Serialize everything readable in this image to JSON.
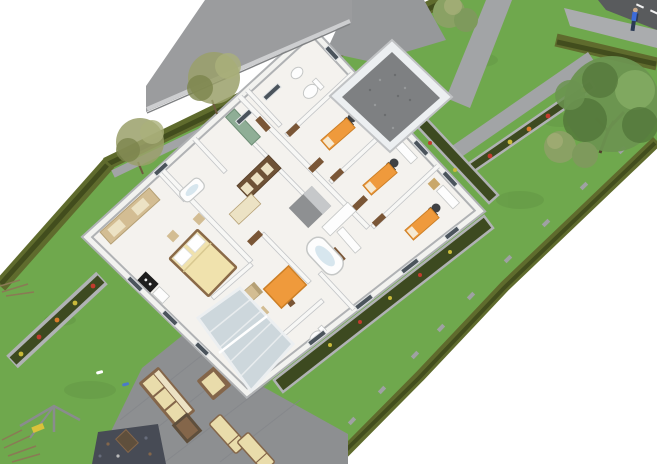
{
  "meta": {
    "description": "3D architectural visualization: bird's-eye cutaway view of a single-storey house floor plan on a long rotated garden plot",
    "render_style": "SketchUp-like model render, no visible text",
    "canvas": {
      "width": 657,
      "height": 464
    }
  },
  "palette": {
    "bg": "#ffffff",
    "lawn": "#6fa84d",
    "lawn_spot": "#619a42",
    "hedge": "#5f6b2d",
    "hedge_dark": "#424d1d",
    "bed_soil": "#3d4a20",
    "curb": "#b0b2b4",
    "path": "#a2a4a6",
    "driveway": "#96989a",
    "patio": "#8d8f91",
    "patio_line": "#84868a",
    "pebbles": "#474b55",
    "road": "#595b5d",
    "sidewalk": "#aaacae",
    "road_mark": "#f2f2f2",
    "roof": "#9b9c9e",
    "roof_fascia": "#cdced0",
    "gravel": "#7e8082",
    "gravel_dot_dark": "#6a6c6e",
    "gravel_dot_light": "#97999b",
    "floor": "#f4f2ee",
    "wall_white": "#f2f2ef",
    "wall_edge": "#b0b2b4",
    "wall_inner": "#f7f7f5",
    "wall_inner_edge": "#c3c5c7",
    "door_wood": "#7a5636",
    "window_dark": "#4b545c",
    "window_frame": "#dfe2e4",
    "glass_green": "#8fae96",
    "glass_green_edge": "#6e8e76",
    "conservatory_glass": "#cdd7dc",
    "conservatory_frame": "#eceff1",
    "cream": "#e9dcab",
    "cream_light": "#ece2c4",
    "tan": "#d3bd93",
    "tan_dark": "#b5a075",
    "wood_brown": "#84664a",
    "wood_dark": "#5f4f3c",
    "bed_spread": "#f0e2ad",
    "bed_frame": "#8a6a48",
    "orange": "#ef9a3c",
    "orange_edge": "#cc7f26",
    "fixture_white": "#fdfdfd",
    "fixture_edge": "#c5c7c6",
    "water_blue": "#d7e6ee",
    "appliance_black": "#1e1e1e",
    "chair_gray": "#3f4144",
    "island_side": "#8e9092",
    "island_top": "#c6c8ca",
    "tree_olive": "#9aa06a",
    "tree_olive_dark": "#7c844c",
    "tree_olive_light": "#aab07a",
    "trunk_brown": "#6e5a3e",
    "tree_green": "#6b9350",
    "tree_green_dark": "#527539",
    "tree_green_light": "#83aa62",
    "bush_green": "#8aa164",
    "bush_green_dark": "#7e9a5c",
    "flower_red": "#c23b2e",
    "flower_yellow": "#c9ba3a",
    "flower_orange": "#d97b2a",
    "dry_branch": "#8a7a55",
    "person_shirt": "#3c6bd9",
    "person_pants": "#2c3a55",
    "person_skin": "#c9a98c",
    "dryer_metal": "#8a8c8e",
    "dryer_seat": "#d9c23a",
    "stepping_stone": "#9fa1a3"
  },
  "scene": {
    "site": {
      "plot": "long rectangular garden plot rotated diagonally, lawn with clipped hedge borders",
      "borders": [
        "top-left hedge row",
        "left hedge row",
        "bottom-right hedge row with stepping stones"
      ],
      "street_corner": [
        "asphalt road with lane markings",
        "light sidewalk",
        "street-side hedge",
        "pedestrian figure"
      ]
    },
    "house": {
      "type": "single-storey flat-roof house shown as roofless cutaway",
      "roofed_parts": [
        "gray flat roof slab over garage (top-left)",
        "white-framed gravel atrium / patio roof opening"
      ],
      "rooms": [
        "master bedroom",
        "two small bathrooms",
        "hallway with shelving",
        "kitchen with island",
        "living room with orange rug",
        "central bathroom with oval tub",
        "WC",
        "corridor",
        "office/kids room 1",
        "office/kids room 2",
        "office/kids room 3",
        "top bathroom with toilet and sink"
      ],
      "furniture_counts": {
        "desks": 3,
        "office_chairs": 3,
        "orange_beds": 3,
        "double_bed": 1,
        "wardrobes": 2,
        "bathtubs": 2,
        "toilets": 2,
        "sinks": 2
      },
      "annex": "glass-roofed conservatory / entrance porch at lower corner"
    },
    "garden": {
      "paths": [
        "driveway from top",
        "gate walkway to street",
        "small north path",
        "path strip along top hedge"
      ],
      "planting_beds": [
        "left flower bed (red/yellow/orange)",
        "gate walkway bed",
        "beds wrapping house right and lower walls",
        "dark pebble bed with wooden table"
      ],
      "trees": [
        "two dry olive trees top-left",
        "large green tree right",
        "double round bush top",
        "two round bushes under tree",
        "dry shrubs bottom-left"
      ],
      "patio": [
        "outdoor sofa",
        "armchair",
        "coffee table",
        "two sun loungers"
      ],
      "other": [
        "rotary dryer / swing frame",
        "two small lawn objects"
      ]
    }
  }
}
